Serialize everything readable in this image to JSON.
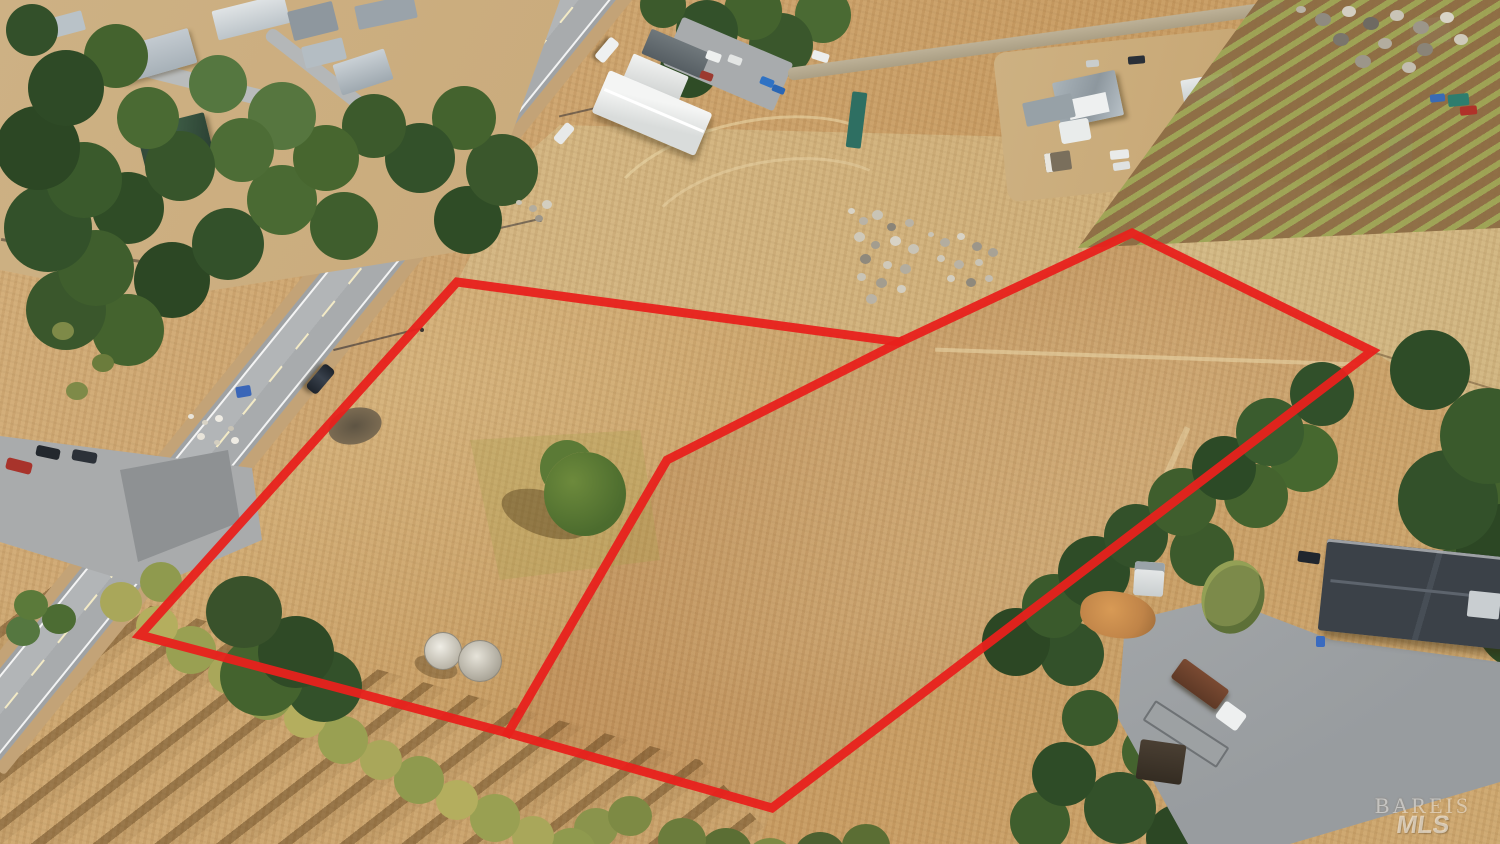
{
  "image": {
    "type": "aerial-drone-photo",
    "description": "Oblique aerial drone photo of two adjoining vacant dry-grass land parcels outlined in red, beside a two-lane rural road with a residential neighborhood at upper left, a farmhouse and orchard rows at upper right, water tanks, tree lines and a home with a gravel driveway at lower right."
  },
  "boundary": {
    "color": "#e8211c",
    "stroke_width": 9,
    "outer_points": "457,282 900,342 1132,233 1372,351 772,808 508,733 140,635",
    "inner_points": "900,342 667,460 508,733"
  },
  "watermark": {
    "line1": "BAREIS",
    "line2": "MLS"
  },
  "palette": {
    "boundary_red": "#e8211c",
    "dry_grass_light": "#d9bd8d",
    "dry_grass_mid": "#c89c63",
    "dry_grass_brown": "#b98a52",
    "asphalt": "#a8abad",
    "tree_dark_green": "#33512a",
    "tree_olive": "#a9a75a",
    "roof_gray": "#b9c2c8",
    "rust_roof": "#a06b47",
    "house_dark_roof": "#3b4148"
  }
}
